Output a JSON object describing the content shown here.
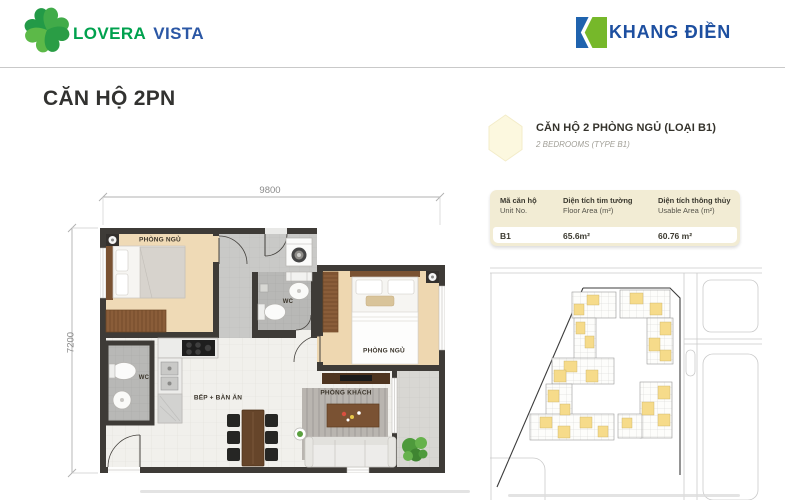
{
  "header": {
    "lovera": {
      "part1": "LOVERA",
      "part2": "VISTA"
    },
    "khangdien": {
      "brand": "KHANG ĐIỀN"
    }
  },
  "page": {
    "title": "CĂN HỘ 2PN"
  },
  "unit_info": {
    "title": "CĂN HỘ 2 PHÒNG NGỦ (LOẠI B1)",
    "subtitle": "2 BEDROOMS (TYPE B1)"
  },
  "table": {
    "columns": [
      {
        "vi": "Mã căn hộ",
        "en": "Unit No."
      },
      {
        "vi": "Diện tích tim tường",
        "en": "Floor Area (m²)"
      },
      {
        "vi": "Diện tích thông thủy",
        "en": "Usable Area (m²)"
      }
    ],
    "row": {
      "unit_no": "B1",
      "floor_area": "65.6m²",
      "usable_area": "60.76 m²"
    }
  },
  "floorplan": {
    "dim_width": "9800",
    "dim_height": "7200",
    "rooms": {
      "bedroom1": "PHÒNG NGỦ",
      "bedroom2": "PHÒNG NGỦ",
      "wc1": "WC",
      "wc2": "WC",
      "kitchen": "BẾP + BÀN ĂN",
      "living": "PHÒNG KHÁCH"
    }
  },
  "colors": {
    "brand_green": "#00a14e",
    "brand_blue": "#1d4fa0",
    "accent_cream": "#f2ecd4",
    "highlight_yellow": "#f6db8a",
    "wall_dark": "#3e3b37"
  }
}
